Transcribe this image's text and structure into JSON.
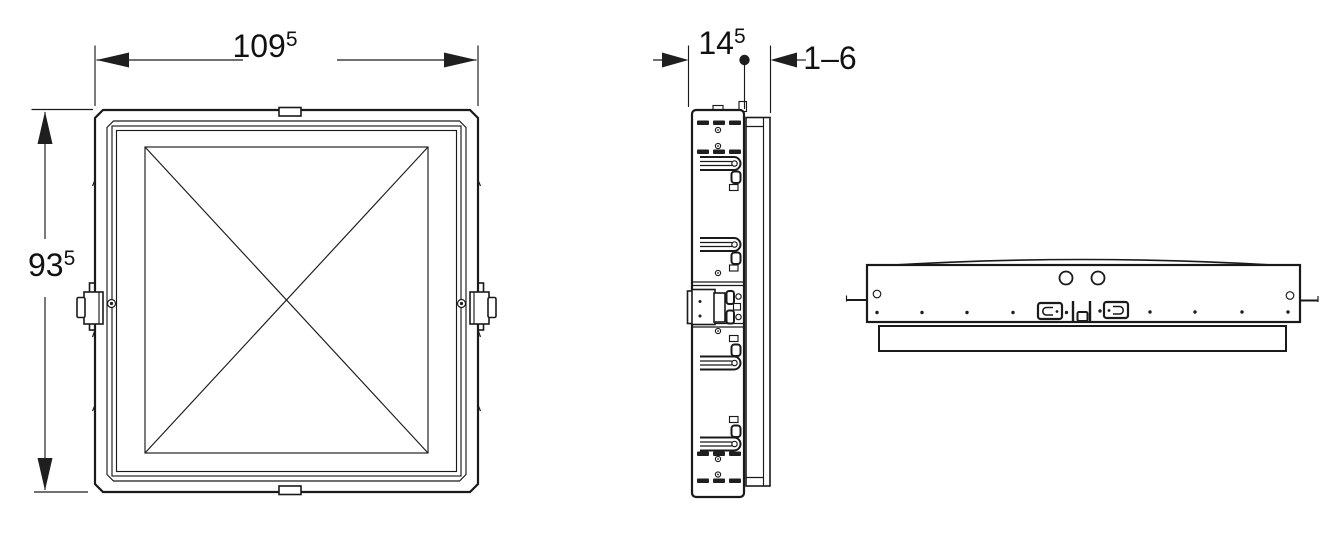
{
  "meta": {
    "drawing_type": "technical-drawing-3-views",
    "background_color": "#ffffff",
    "line_color": "#1a1a1a"
  },
  "dimensions": {
    "front_width": {
      "value": "109",
      "superscript": "5"
    },
    "front_height": {
      "value": "93",
      "superscript": "5"
    },
    "side_depth": {
      "value": "14",
      "superscript": "5"
    },
    "wall_offset_range": {
      "value": "1–6"
    }
  }
}
